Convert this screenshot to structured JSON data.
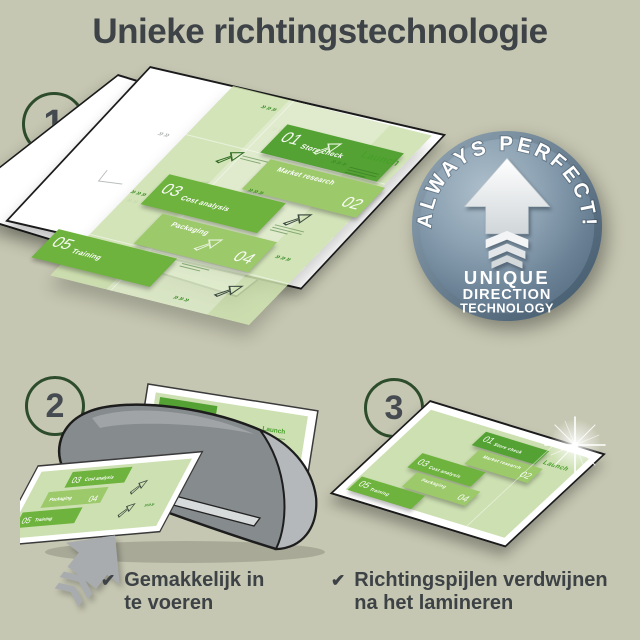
{
  "title": "Unieke richtingstechnologie",
  "steps": {
    "one": "1",
    "two": "2",
    "three": "3"
  },
  "slide": {
    "launch_label": "Launch",
    "direction_marks": "»»»",
    "items": [
      {
        "num": "01",
        "label": "Store check"
      },
      {
        "num": "02",
        "label": "Market research"
      },
      {
        "num": "03",
        "label": "Cost analysis"
      },
      {
        "num": "04",
        "label": "Packaging"
      },
      {
        "num": "05",
        "label": "Training"
      }
    ]
  },
  "badge": {
    "arc_text": "ALWAYS PERFECT!",
    "lines": [
      "UNIQUE",
      "DIRECTION",
      "TECHNOLOGY"
    ]
  },
  "checklist": [
    {
      "mark": "✔",
      "line1": "Gemakkelijk in",
      "line2": "te voeren"
    },
    {
      "mark": "✔",
      "line1": "Richtingspijlen verdwijnen",
      "line2": "na het lamineren"
    }
  ],
  "colors": {
    "background": "#c6c7b2",
    "ink": "#3d4347",
    "accent_green": "#6db33d",
    "badge_blue": "#7f97a9"
  }
}
